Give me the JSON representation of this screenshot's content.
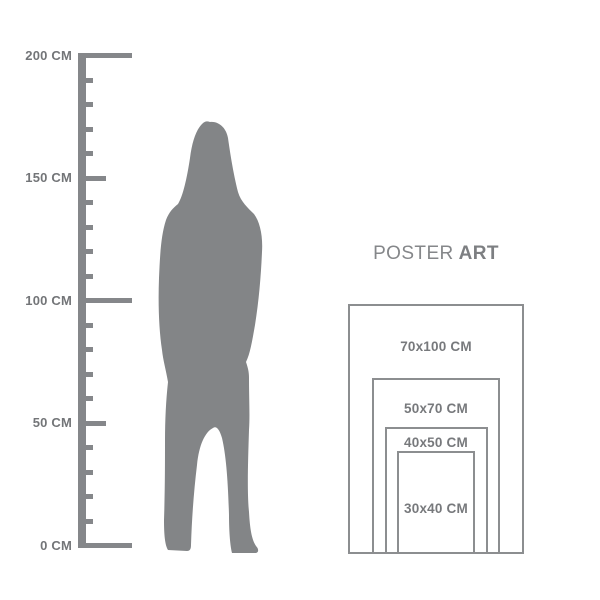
{
  "ruler": {
    "unit": "CM",
    "min_cm": 0,
    "max_cm": 200,
    "tick_step_cm": 10,
    "labels": [
      {
        "cm": 200,
        "text": "200 CM"
      },
      {
        "cm": 150,
        "text": "150 CM"
      },
      {
        "cm": 100,
        "text": "100 CM"
      },
      {
        "cm": 50,
        "text": "50 CM"
      },
      {
        "cm": 0,
        "text": "0 CM"
      }
    ]
  },
  "figure": {
    "description": "standing-woman-silhouette"
  },
  "brand": {
    "word1": "POSTER",
    "word2": "ART"
  },
  "poster_sizes": [
    {
      "label": "70x100 CM",
      "width_cm": 70,
      "height_cm": 100
    },
    {
      "label": "50x70 CM",
      "width_cm": 50,
      "height_cm": 70
    },
    {
      "label": "40x50 CM",
      "width_cm": 40,
      "height_cm": 50
    },
    {
      "label": "30x40 CM",
      "width_cm": 30,
      "height_cm": 40
    }
  ],
  "colors": {
    "background": "#ffffff",
    "ruler_gray": "#85878a",
    "silhouette_gray": "#838587",
    "border_gray": "#8c8e90",
    "text_gray": "#737578"
  }
}
